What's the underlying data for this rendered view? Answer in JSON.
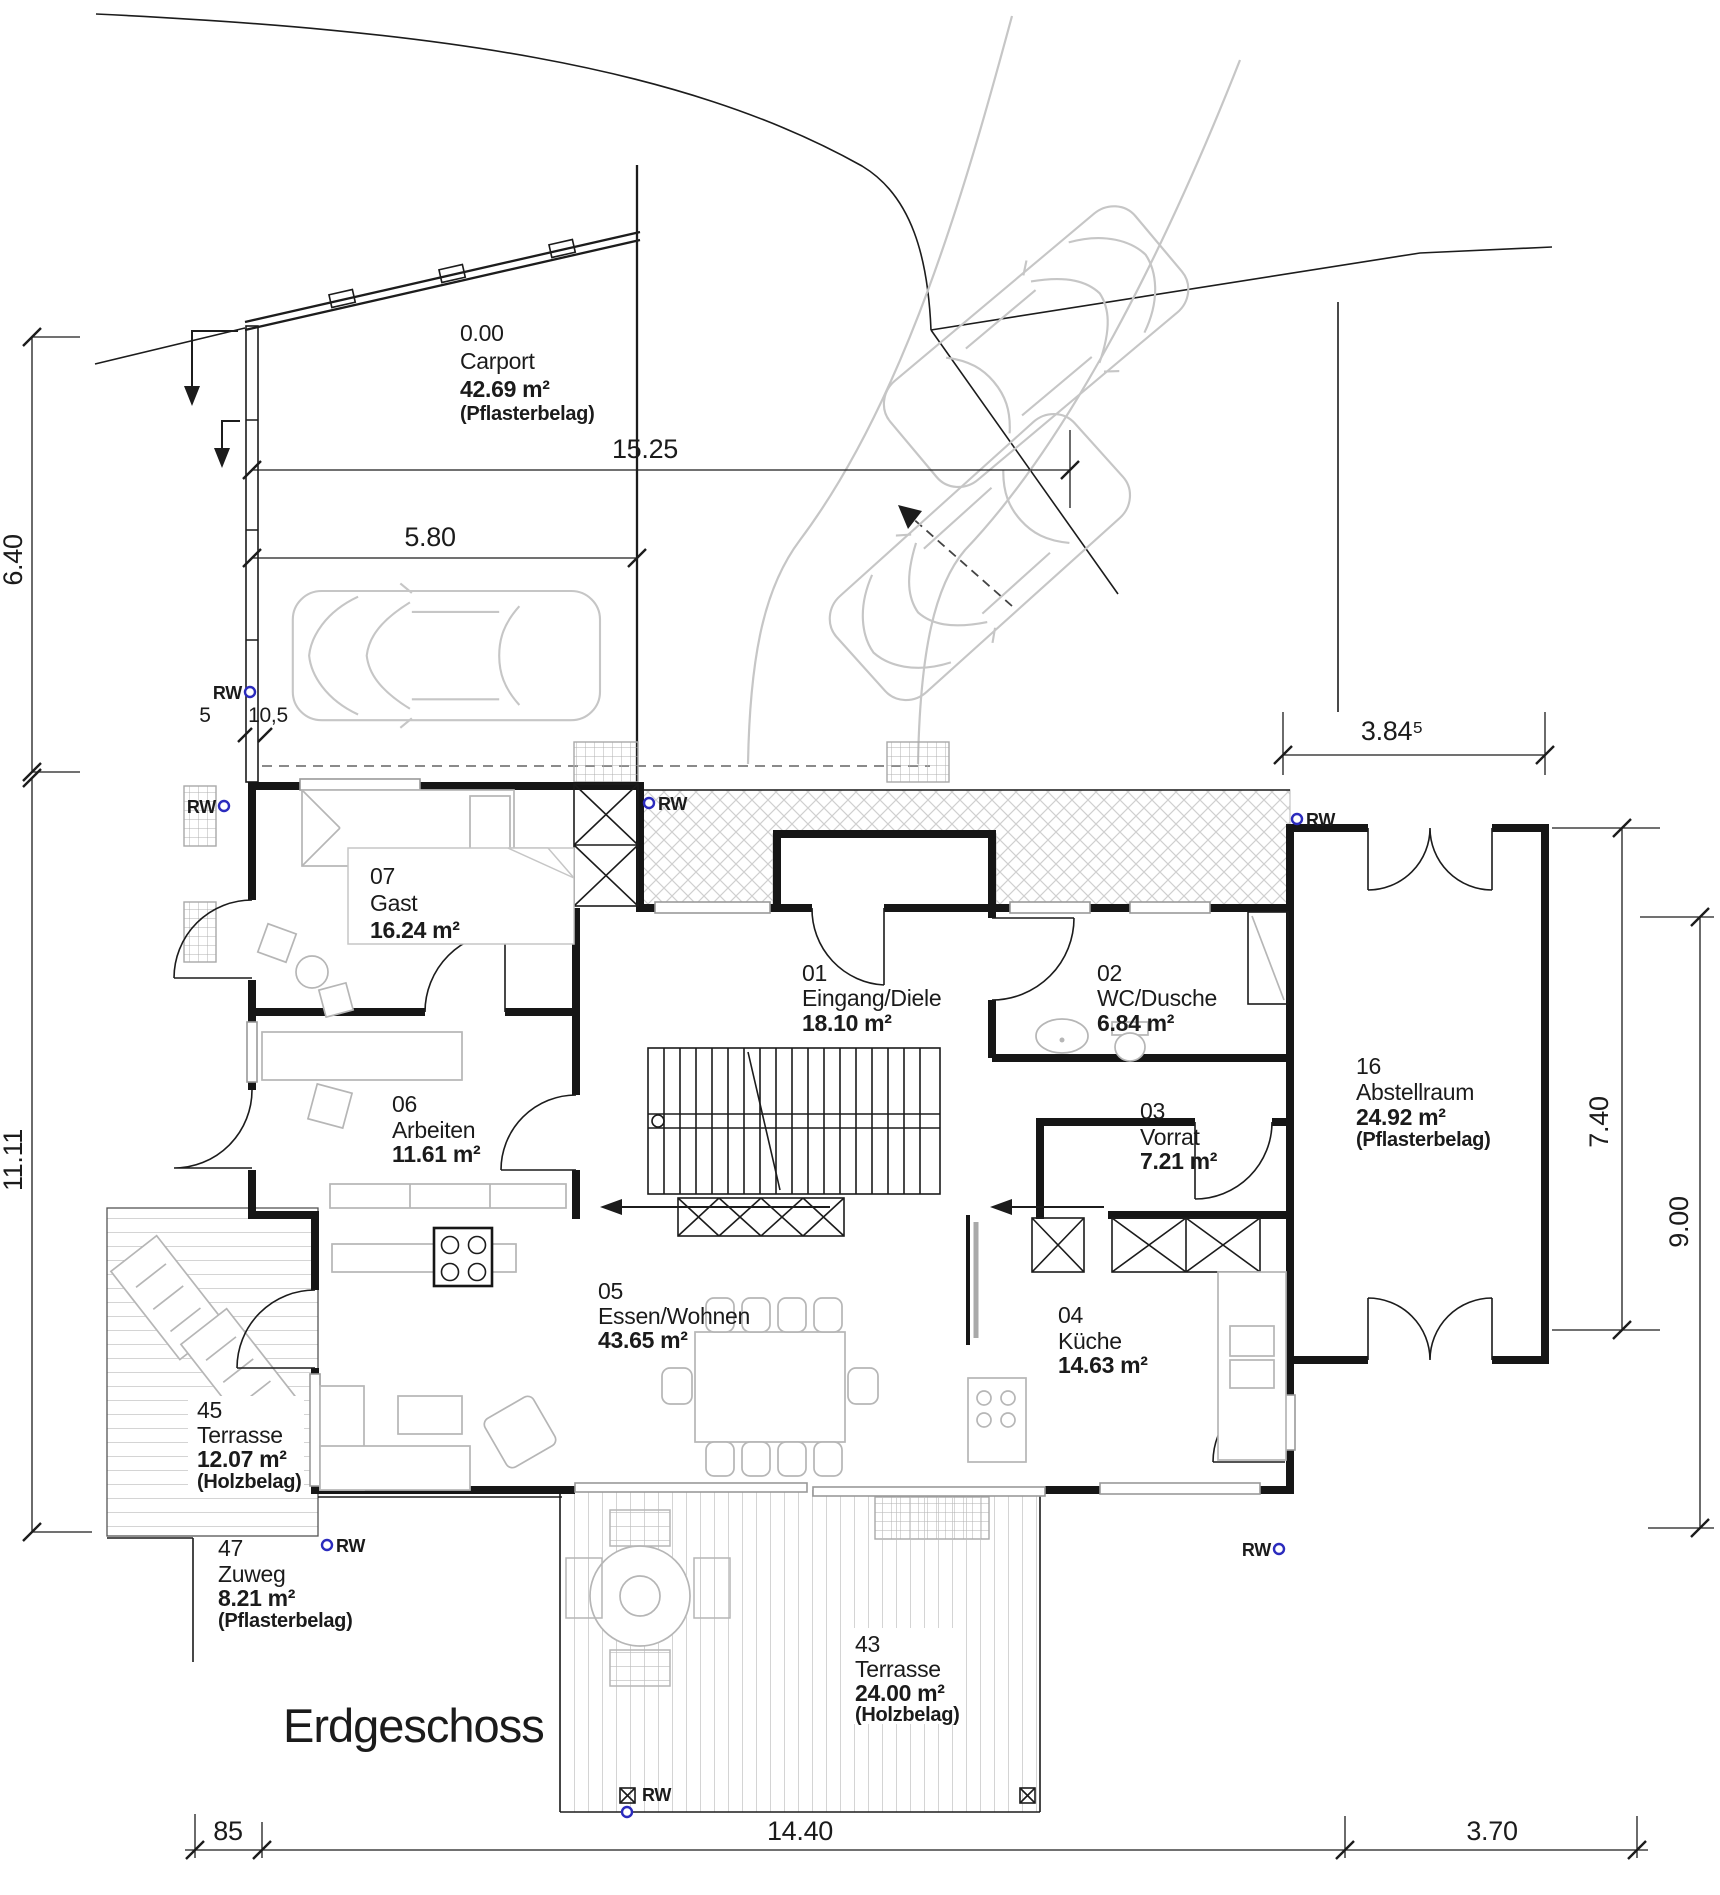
{
  "meta": {
    "floor_title": "Erdgeschoss"
  },
  "rooms": [
    {
      "number": "0.00",
      "name": "Carport",
      "area": "42.69 m²",
      "surface": "(Pflasterbelag)"
    },
    {
      "number": "01",
      "name": "Eingang/Diele",
      "area": "18.10 m²",
      "surface": ""
    },
    {
      "number": "02",
      "name": "WC/Dusche",
      "area": "6.84 m²",
      "surface": ""
    },
    {
      "number": "03",
      "name": "Vorrat",
      "area": "7.21 m²",
      "surface": ""
    },
    {
      "number": "04",
      "name": "Küche",
      "area": "14.63 m²",
      "surface": ""
    },
    {
      "number": "05",
      "name": "Essen/Wohnen",
      "area": "43.65 m²",
      "surface": ""
    },
    {
      "number": "06",
      "name": "Arbeiten",
      "area": "11.61 m²",
      "surface": ""
    },
    {
      "number": "07",
      "name": "Gast",
      "area": "16.24 m²",
      "surface": ""
    },
    {
      "number": "16",
      "name": "Abstellraum",
      "area": "24.92 m²",
      "surface": "(Pflasterbelag)"
    },
    {
      "number": "43",
      "name": "Terrasse",
      "area": "24.00 m²",
      "surface": "(Holzbelag)"
    },
    {
      "number": "45",
      "name": "Terrasse",
      "area": "12.07 m²",
      "surface": "(Holzbelag)"
    },
    {
      "number": "47",
      "name": "Zuweg",
      "area": "8.21 m²",
      "surface": "(Pflasterbelag)"
    }
  ],
  "dimensions": {
    "site_width": "15.25",
    "carport_width": "5.80",
    "left_upper": "6.40",
    "left_lower": "11.11",
    "storage_width": "3.84⁵",
    "right_inner": "7.40",
    "right_outer": "9.00",
    "bottom_left": "85",
    "bottom_center": "14.40",
    "bottom_right": "3.70",
    "wall_a": "5",
    "wall_b": "10,5"
  },
  "markers": {
    "rainwater_label": "RW"
  },
  "colors": {
    "wall": "#161616",
    "furniture_gray": "#b6b6b6",
    "car_gray": "#c6c6c6",
    "rw_blue": "#2b2bbd",
    "hatch_gray": "#d0d0d0"
  }
}
